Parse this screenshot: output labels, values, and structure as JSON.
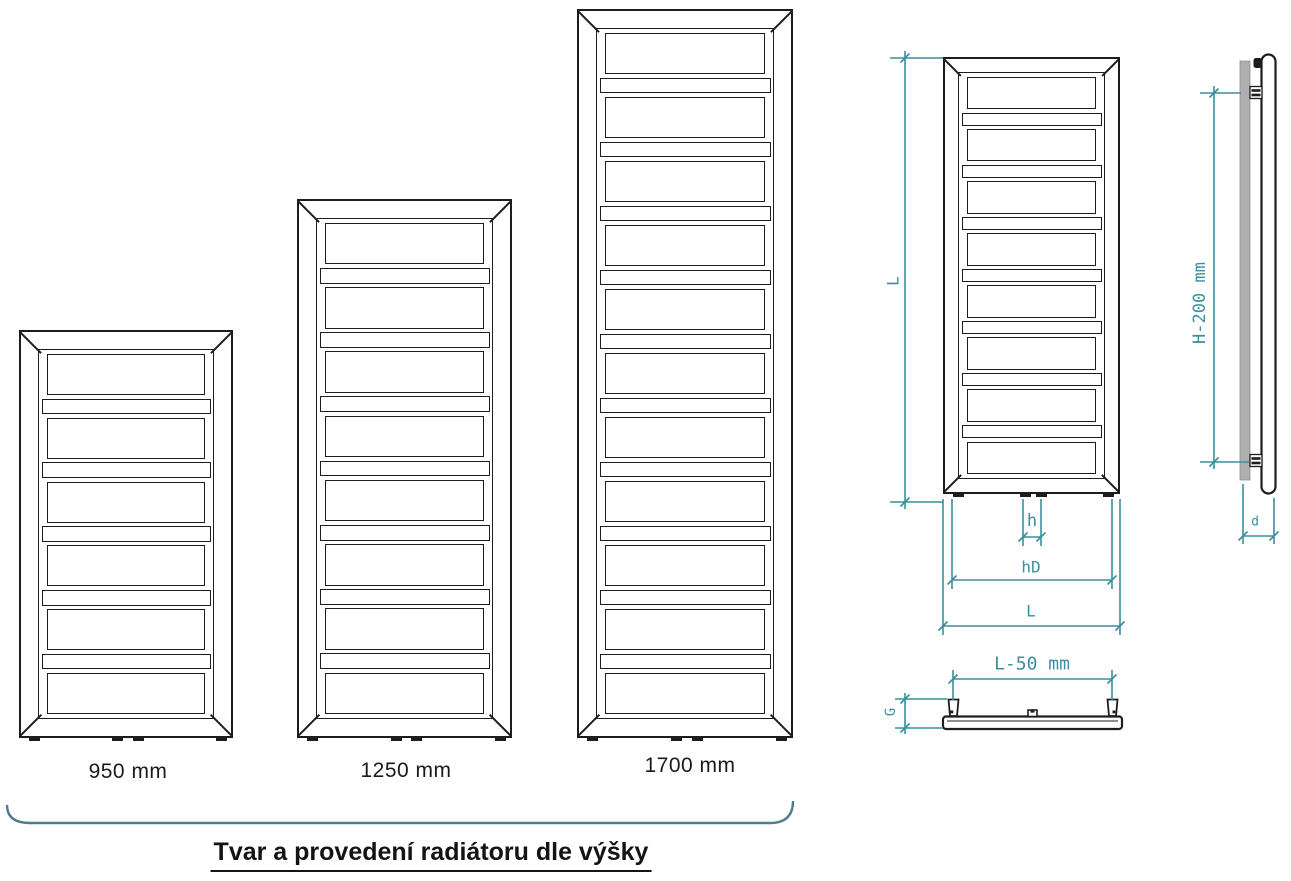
{
  "caption": "Tvar a provedení radiátoru dle výšky",
  "colors": {
    "line": "#1d1d1d",
    "dimension": "#3a8f9e",
    "brace": "#4e7e8d",
    "wall_panel_gray": "#aeaeae",
    "label_text": "#1a1a1a",
    "background": "#ffffff"
  },
  "radiators": [
    {
      "name": "radiator-950",
      "label": "950 mm",
      "wide_slats": 6,
      "narrow_slats": 5
    },
    {
      "name": "radiator-1250",
      "label": "1250 mm",
      "wide_slats": 8,
      "narrow_slats": 7
    },
    {
      "name": "radiator-1700",
      "label": "1700 mm",
      "wide_slats": 11,
      "narrow_slats": 10
    },
    {
      "name": "radiator-front-view",
      "label": "",
      "wide_slats": 8,
      "narrow_slats": 7
    }
  ],
  "dimension_labels": {
    "front_height": "L",
    "connection_offset": "h",
    "connection_spread": "hD",
    "front_width": "L",
    "bracket_span_vertical": "H-200 mm",
    "depth": "d",
    "bracket_span_horizontal": "L-50 mm",
    "bracket_depth": "G"
  }
}
